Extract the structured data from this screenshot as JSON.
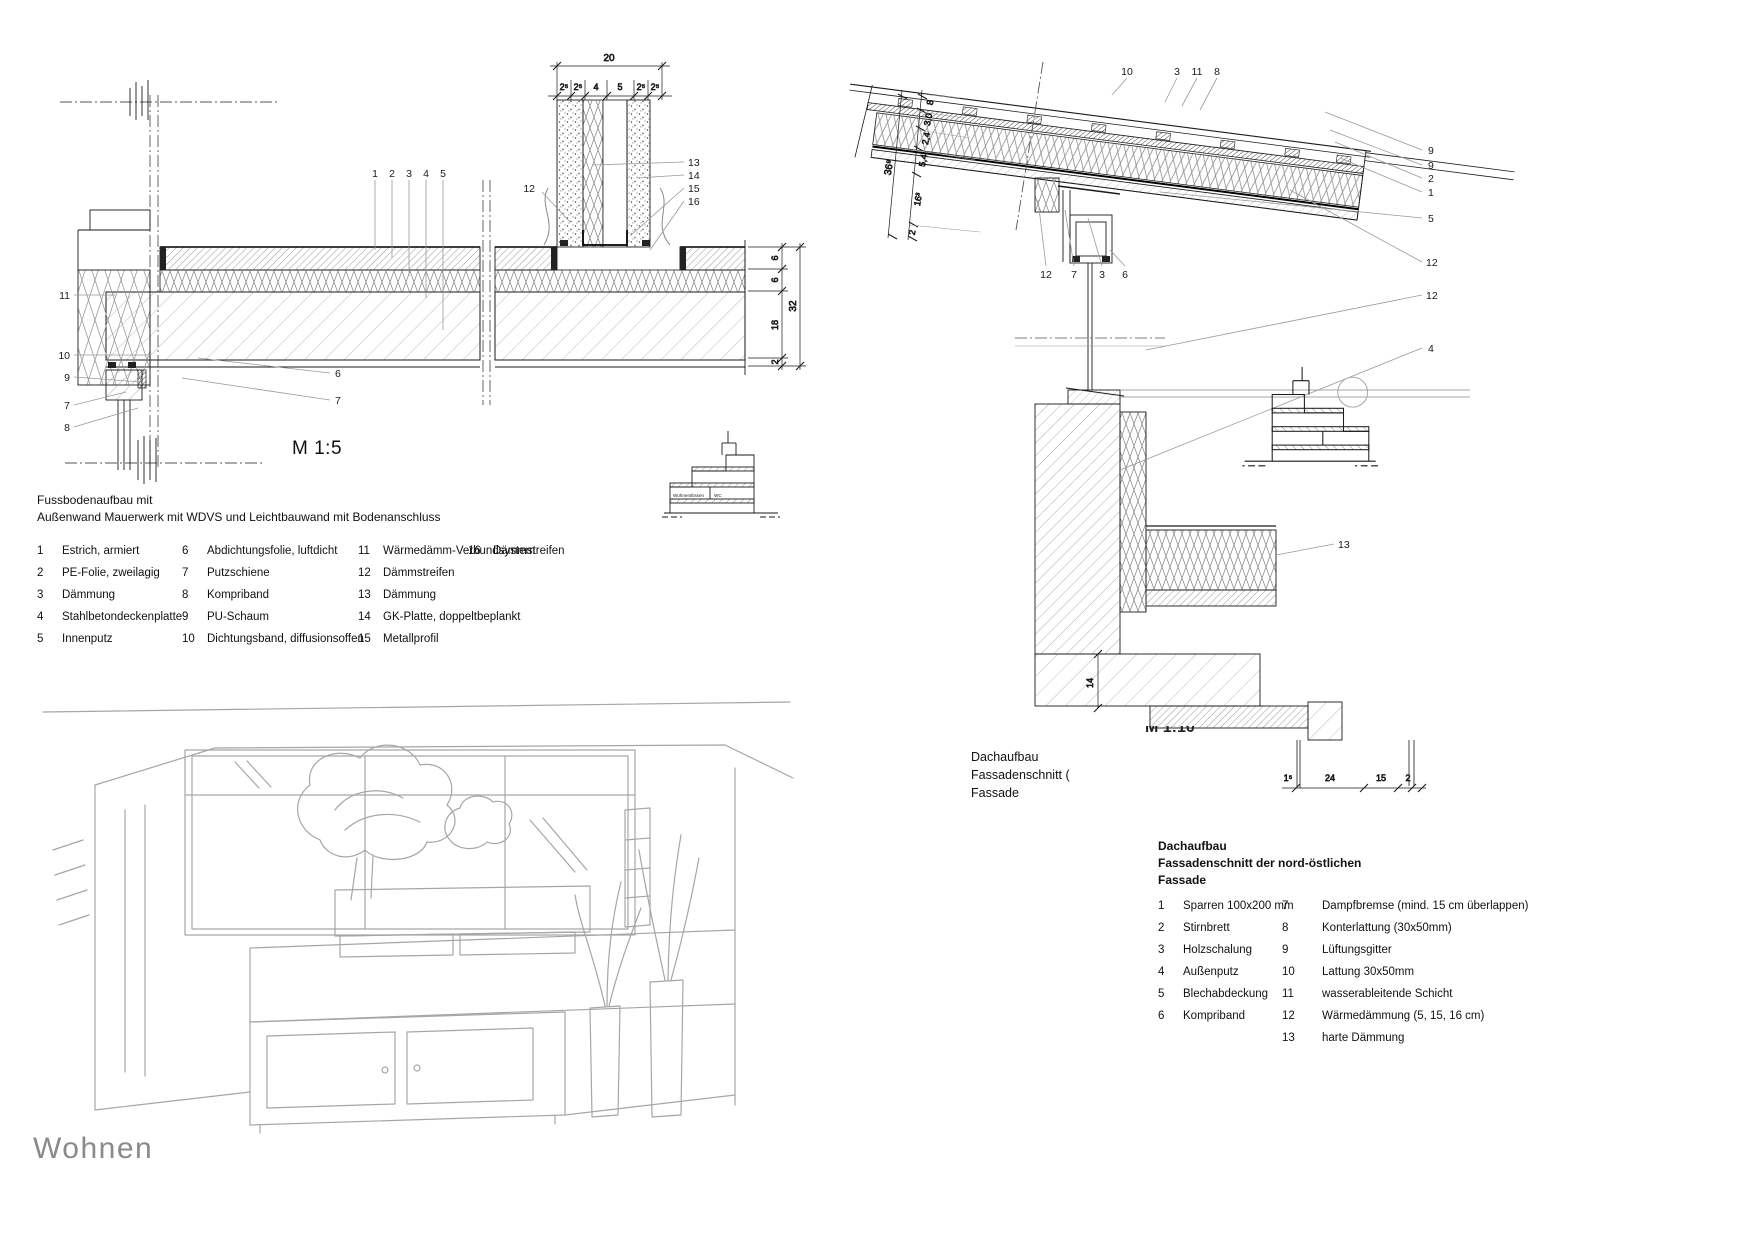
{
  "sheet_title": "Wohnen",
  "floor_detail": {
    "scale_label": "M 1:5",
    "top_dim": {
      "overall": "20",
      "segments": [
        "2⁵",
        "2⁵",
        "4",
        "5",
        "2⁵",
        "2⁵"
      ]
    },
    "right_dim": {
      "overall": "32",
      "segments": [
        "6",
        "6",
        "18",
        "2"
      ]
    },
    "callouts_top": [
      "1",
      "2",
      "3",
      "4",
      "5"
    ],
    "callouts_right": [
      "13",
      "14",
      "15",
      "16"
    ],
    "callout_mid": "12",
    "callouts_left": [
      "11",
      "10",
      "9",
      "7",
      "8"
    ],
    "callouts_inner": [
      "6",
      "7"
    ],
    "keyplan_labels": [
      "Wohnen/Essen",
      "WC"
    ]
  },
  "floor_legend": {
    "title_line1": "Fussbodenaufbau mit",
    "title_line2": "Außenwand Mauerwerk mit WDVS und Leichtbauwand mit Bodenanschluss",
    "columns": [
      [
        {
          "n": "1",
          "t": "Estrich, armiert"
        },
        {
          "n": "2",
          "t": "PE-Folie, zweilagig"
        },
        {
          "n": "3",
          "t": "Dämmung"
        },
        {
          "n": "4",
          "t": "Stahlbetondeckenplatte"
        },
        {
          "n": "5",
          "t": "Innenputz"
        }
      ],
      [
        {
          "n": "6",
          "t": "Abdichtungsfolie, luftdicht"
        },
        {
          "n": "7",
          "t": "Putzschiene"
        },
        {
          "n": "8",
          "t": "Kompriband"
        },
        {
          "n": "9",
          "t": "PU-Schaum"
        },
        {
          "n": "10",
          "t": "Dichtungsband, diffusionsoffen"
        }
      ],
      [
        {
          "n": "11",
          "t": "Wärmedämm-Verbundsystem"
        },
        {
          "n": "12",
          "t": "Dämmstreifen"
        },
        {
          "n": "13",
          "t": "Dämmung"
        },
        {
          "n": "14",
          "t": "GK-Platte, doppeltbeplankt"
        },
        {
          "n": "15",
          "t": "Metallprofil"
        }
      ],
      [
        {
          "n": "16",
          "t": "Dämmstreifen"
        }
      ]
    ]
  },
  "roof_detail": {
    "scale_label_clipped": "M 1:10",
    "caption_line1": "Dachaufbau",
    "caption_line2": "Fassadenschnitt (",
    "caption_line3": "Fassade",
    "callouts_top": [
      "10",
      "3",
      "11",
      "8"
    ],
    "callouts_right": [
      "9",
      "9",
      "2",
      "1",
      "5",
      "12",
      "12",
      "4"
    ],
    "callouts_mid": [
      "12",
      "7",
      "3",
      "6"
    ],
    "callout_13": "13",
    "dim_14": "14",
    "slope_dim": {
      "overall": "36⁹",
      "segments": [
        "8",
        "3,0",
        "2,4",
        "5,4",
        "16³",
        "2"
      ]
    },
    "bottom_dim": [
      "1⁵",
      "24",
      "15",
      "2"
    ]
  },
  "roof_legend": {
    "title_line1": "Dachaufbau",
    "title_line2": "Fassadenschnitt der nord-östlichen",
    "title_line3": "Fassade",
    "columns": [
      [
        {
          "n": "1",
          "t": "Sparren 100x200 mm"
        },
        {
          "n": "2",
          "t": "Stirnbrett"
        },
        {
          "n": "3",
          "t": "Holzschalung"
        },
        {
          "n": "4",
          "t": "Außenputz"
        },
        {
          "n": "5",
          "t": "Blechabdeckung"
        },
        {
          "n": "6",
          "t": "Kompriband"
        }
      ],
      [
        {
          "n": "7",
          "t": "Dampfbremse (mind. 15 cm überlappen)"
        },
        {
          "n": "8",
          "t": "Konterlattung (30x50mm)"
        },
        {
          "n": "9",
          "t": "Lüftungsgitter"
        },
        {
          "n": "10",
          "t": "Lattung 30x50mm"
        },
        {
          "n": "11",
          "t": "wasserableitende Schicht"
        },
        {
          "n": "12",
          "t": "Wärmedämmung (5, 15, 16 cm)"
        },
        {
          "n": "13",
          "t": "harte Dämmung"
        }
      ]
    ]
  }
}
